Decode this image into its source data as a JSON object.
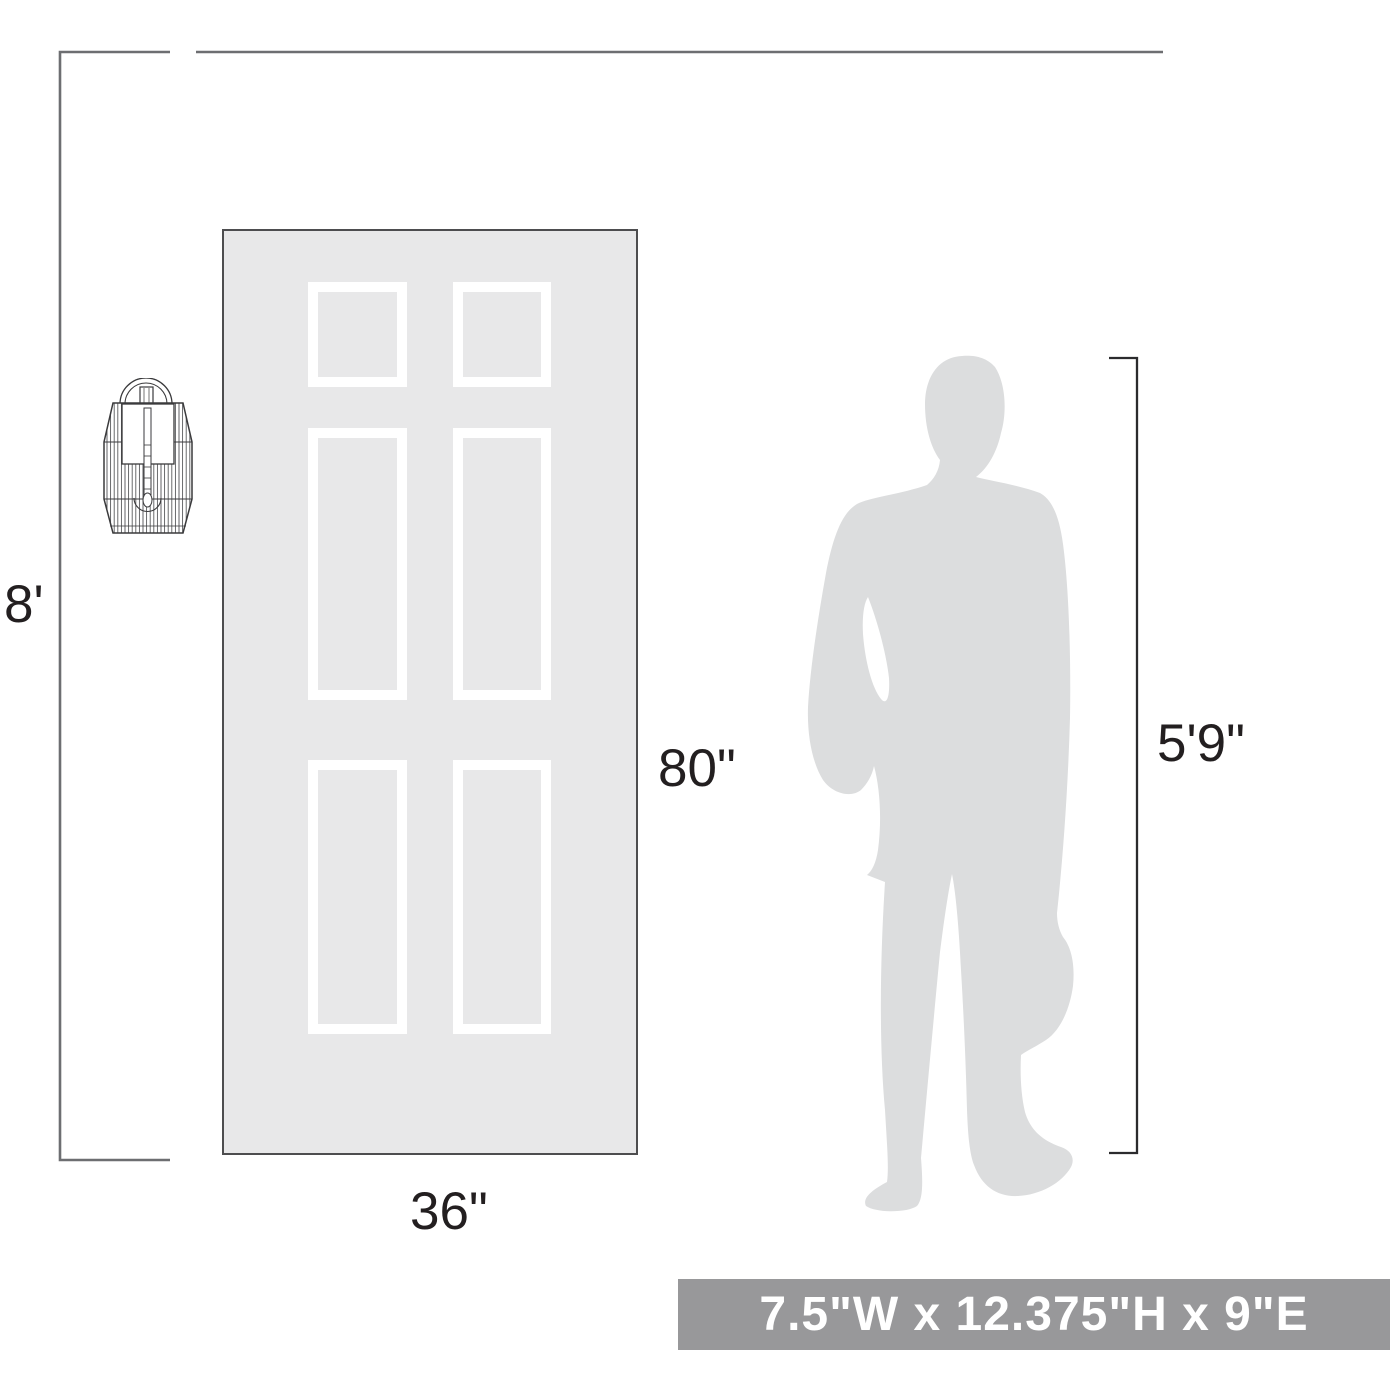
{
  "scene": {
    "title": "Wall sconce scale reference diagram",
    "elements": [
      "wall-sconce",
      "six-panel-door",
      "standing-person",
      "dimension-lines"
    ]
  },
  "labels": {
    "ceiling_height": "8'",
    "door_height": "80\"",
    "door_width": "36\"",
    "person_height": "5'9\""
  },
  "banner": {
    "dimensions_text": "7.5\"W x 12.375\"H x 9\"E"
  },
  "icons": {
    "sconce": "wall-sconce-line-drawing",
    "door": "six-panel-door-silhouette",
    "person": "standing-man-silhouette"
  },
  "colors": {
    "background": "#ffffff",
    "door_fill": "#e8e8e9",
    "door_border": "#4d4d4f",
    "panel_white": "#ffffff",
    "person_fill": "#dcddde",
    "dimension_line_gray": "#6d6e71",
    "bracket_line_dark": "#2b2b2d",
    "sconce_line": "#3a3a3c",
    "label_text": "#231f20",
    "banner_bg": "#98989a",
    "banner_text": "#ffffff"
  }
}
